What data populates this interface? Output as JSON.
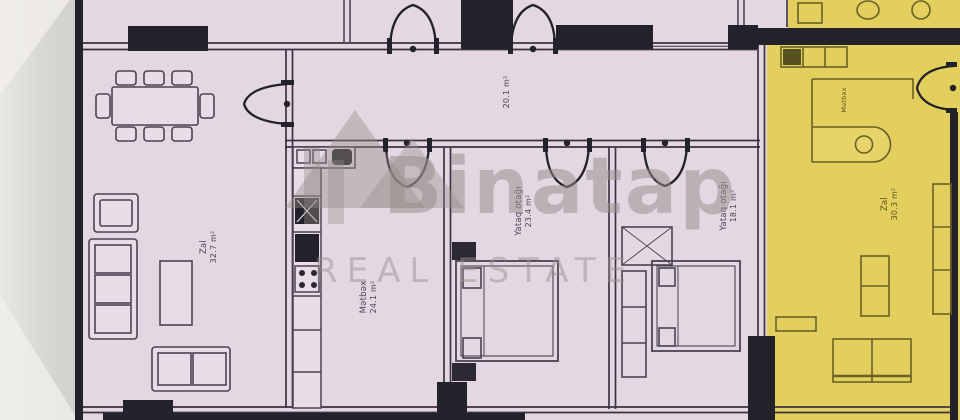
{
  "watermark": {
    "brand": "Binatap",
    "tagline": "REAL ESTATE"
  },
  "rooms": [
    {
      "id": "hallway",
      "name": "",
      "area": "20.1 m²"
    },
    {
      "id": "living-room",
      "name": "Zal",
      "area": "32.7 m²"
    },
    {
      "id": "kitchen",
      "name": "Mətbəx",
      "area": "24.1 m²"
    },
    {
      "id": "bedroom-1",
      "name": "Yataq otağı",
      "area": "23.4 m²"
    },
    {
      "id": "bedroom-2",
      "name": "Yataq otağı",
      "area": "18.1 m²"
    },
    {
      "id": "highlight-living-room",
      "name": "Zal",
      "area": "30.3 m²"
    },
    {
      "id": "highlight-kitchen",
      "name": "Mətbəx",
      "area": ""
    }
  ],
  "colors": {
    "plan_fill": "#e3d7e1",
    "highlight_fill": "#e2cf5e",
    "wall": "#232129",
    "watermark": "#968d8c",
    "margin_gray": "#dcdad6"
  }
}
